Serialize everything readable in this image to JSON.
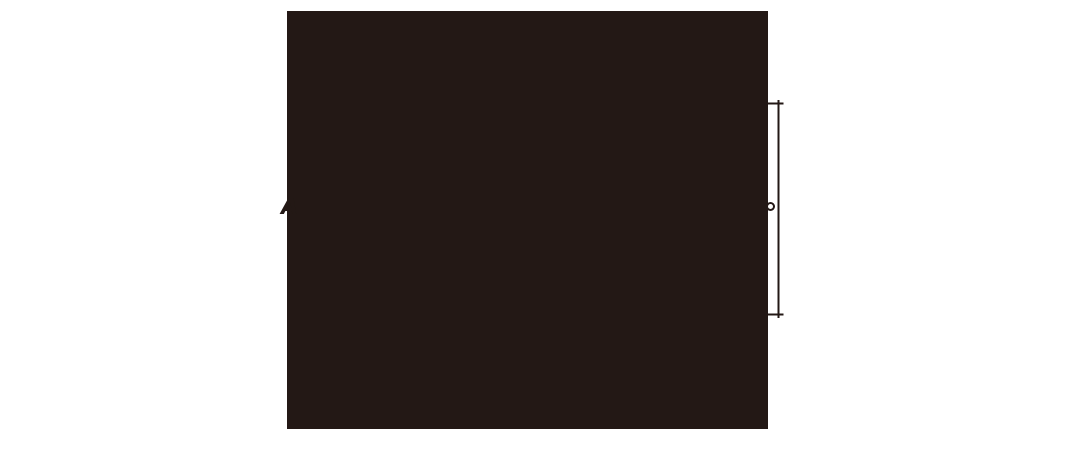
{
  "diagram": {
    "background_color": "#ffffff",
    "panel": {
      "label": "A",
      "color": "#231815"
    },
    "dimension": {
      "stroke_color": "#231815",
      "knob_fill": "#ffffff"
    }
  }
}
